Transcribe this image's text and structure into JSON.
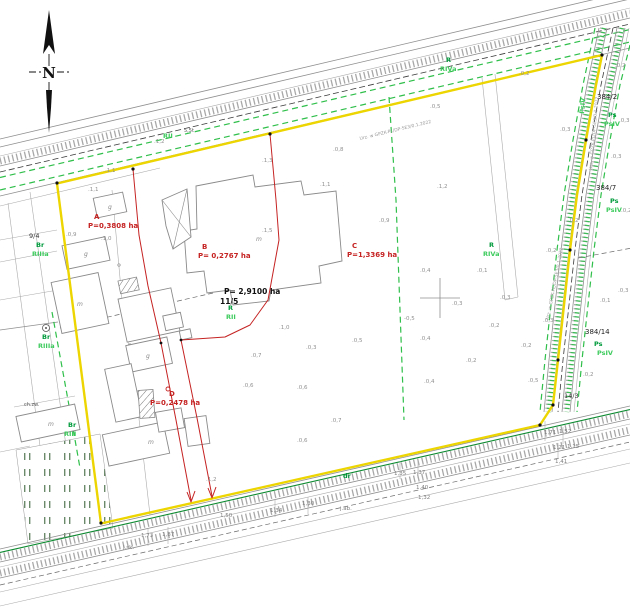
{
  "map_type": "cadastral-survey-map",
  "compass": {
    "north_label": "N"
  },
  "colors": {
    "boundary_yellow": "#ecd500",
    "division_red": "#c52222",
    "vegetation_green": "#2fbf4a",
    "utility_green": "#0c8a30",
    "soil_label_green": "#009a3c",
    "soil_class_green": "#3ecb5e",
    "road_gray": "#8f8f8f"
  },
  "map_labels": [
    {
      "text": "A",
      "x": 94,
      "y": 219,
      "kind": "red",
      "name": "parcel-a-letter"
    },
    {
      "text": "P=0,3808 ha",
      "x": 88,
      "y": 228,
      "kind": "red",
      "name": "parcel-a-area"
    },
    {
      "text": "B",
      "x": 202,
      "y": 249,
      "kind": "red",
      "name": "parcel-b-letter"
    },
    {
      "text": "P= 0,2767 ha",
      "x": 198,
      "y": 258,
      "kind": "red",
      "name": "parcel-b-area"
    },
    {
      "text": "C",
      "x": 352,
      "y": 248,
      "kind": "red",
      "name": "parcel-c-letter"
    },
    {
      "text": "P=1,3369 ha",
      "x": 347,
      "y": 257,
      "kind": "red",
      "name": "parcel-c-area"
    },
    {
      "text": "D",
      "x": 169,
      "y": 396,
      "kind": "red",
      "name": "parcel-d-letter"
    },
    {
      "text": "P=0,2478 ha",
      "x": 150,
      "y": 405,
      "kind": "red",
      "name": "parcel-d-area"
    },
    {
      "text": "P= 2,9100 ha",
      "x": 224,
      "y": 294,
      "kind": "blackb",
      "name": "parcel-115-area"
    },
    {
      "text": "11/5",
      "x": 220,
      "y": 304,
      "kind": "blackb",
      "name": "parcel-115-number"
    },
    {
      "text": "384/2",
      "x": 597,
      "y": 99,
      "kind": "blk",
      "name": "parcel-384-2"
    },
    {
      "text": "384/7",
      "x": 596,
      "y": 190,
      "kind": "blk",
      "name": "parcel-384-7"
    },
    {
      "text": "384/14",
      "x": 585,
      "y": 334,
      "kind": "blk",
      "name": "parcel-384-14"
    },
    {
      "text": "14/3",
      "x": 564,
      "y": 398,
      "kind": "blks",
      "name": "parcel-14-3"
    },
    {
      "text": "9/4",
      "x": 29,
      "y": 238,
      "kind": "blks",
      "name": "parcel-9-4"
    },
    {
      "text": "R",
      "x": 446,
      "y": 62,
      "kind": "grn",
      "name": "soil-label"
    },
    {
      "text": "RIVa",
      "x": 440,
      "y": 71,
      "kind": "grnl",
      "name": "soil-class"
    },
    {
      "text": "R",
      "x": 489,
      "y": 247,
      "kind": "grn",
      "name": "soil-label"
    },
    {
      "text": "RIVa",
      "x": 483,
      "y": 256,
      "kind": "grnl",
      "name": "soil-class"
    },
    {
      "text": "RII",
      "x": 163,
      "y": 138,
      "kind": "grnl",
      "name": "soil-class"
    },
    {
      "text": "R",
      "x": 228,
      "y": 310,
      "kind": "grn",
      "name": "soil-label"
    },
    {
      "text": "RII",
      "x": 226,
      "y": 319,
      "kind": "grnl",
      "name": "soil-class"
    },
    {
      "text": "Br",
      "x": 36,
      "y": 247,
      "kind": "grn",
      "name": "soil-label"
    },
    {
      "text": "RIIIa",
      "x": 32,
      "y": 256,
      "kind": "grnl",
      "name": "soil-class"
    },
    {
      "text": "Br",
      "x": 42,
      "y": 339,
      "kind": "grn",
      "name": "soil-label"
    },
    {
      "text": "RIIIa",
      "x": 38,
      "y": 348,
      "kind": "grnl",
      "name": "soil-class"
    },
    {
      "text": "Br",
      "x": 68,
      "y": 427,
      "kind": "grn",
      "name": "soil-label"
    },
    {
      "text": "RIII",
      "x": 64,
      "y": 436,
      "kind": "grnl",
      "name": "soil-class"
    },
    {
      "text": "Ps",
      "x": 608,
      "y": 117,
      "kind": "grn",
      "name": "soil-label"
    },
    {
      "text": "PsIV",
      "x": 604,
      "y": 126,
      "kind": "grnl",
      "name": "soil-class"
    },
    {
      "text": "Ps",
      "x": 610,
      "y": 203,
      "kind": "grn",
      "name": "soil-label"
    },
    {
      "text": "PsIV",
      "x": 606,
      "y": 212,
      "kind": "grnl",
      "name": "soil-class"
    },
    {
      "text": "Ps",
      "x": 594,
      "y": 346,
      "kind": "grn",
      "name": "soil-label"
    },
    {
      "text": "PsIV",
      "x": 597,
      "y": 355,
      "kind": "grnl",
      "name": "soil-class"
    },
    {
      "text": "dr",
      "x": 343,
      "y": 478,
      "kind": "grn",
      "name": "road-use-label"
    },
    {
      "text": "PsIV",
      "x": 584,
      "y": 114,
      "kind": "grnl",
      "rot": -85,
      "name": "soil-class-rotated"
    },
    {
      "text": "Urz. w GPZK-PL/DP-5E3/0.1.2022",
      "x": 360,
      "y": 140,
      "kind": "util",
      "rot": -13.5,
      "name": "utility-inscription"
    },
    {
      "text": "Urz. w GPZK-PL/DP-5E3/0.1.2022",
      "x": 592,
      "y": 170,
      "kind": "util",
      "rot": -85,
      "name": "utility-inscription"
    },
    {
      "text": "Urz. w GPZK-PL/DP-5E3/0.1.2022",
      "x": 549,
      "y": 320,
      "kind": "util",
      "rot": -79,
      "name": "utility-inscription"
    },
    {
      "text": "5,5t",
      "x": 184,
      "y": 132,
      "kind": "tiny",
      "name": "road-sign-label"
    },
    {
      "text": "ch.zw.",
      "x": 24,
      "y": 406,
      "kind": "tiny",
      "name": "surface-label"
    },
    {
      "text": "m",
      "x": 256,
      "y": 241,
      "kind": "bld",
      "name": "building-use-label"
    },
    {
      "text": "m",
      "x": 77,
      "y": 306,
      "kind": "bld",
      "name": "building-use-label"
    },
    {
      "text": "m",
      "x": 148,
      "y": 444,
      "kind": "bld",
      "name": "building-use-label"
    },
    {
      "text": "m",
      "x": 48,
      "y": 426,
      "kind": "bld",
      "name": "building-use-label"
    },
    {
      "text": "g",
      "x": 108,
      "y": 209,
      "kind": "bld",
      "name": "building-use-label"
    },
    {
      "text": "g",
      "x": 84,
      "y": 256,
      "kind": "bld",
      "name": "building-use-label"
    },
    {
      "text": "g",
      "x": 146,
      "y": 358,
      "kind": "bld",
      "name": "building-use-label"
    },
    {
      "text": ".1,2",
      "x": 154,
      "y": 143,
      "kind": "spot",
      "name": "spot-height"
    },
    {
      "text": ".1,3",
      "x": 262,
      "y": 162,
      "kind": "spot",
      "name": "spot-height"
    },
    {
      "text": ".0,8",
      "x": 333,
      "y": 151,
      "kind": "spot",
      "name": "spot-height"
    },
    {
      "text": ".0,5",
      "x": 430,
      "y": 108,
      "kind": "spot",
      "name": "spot-height"
    },
    {
      "text": ".0,2",
      "x": 519,
      "y": 75,
      "kind": "spot",
      "name": "spot-height"
    },
    {
      "text": ".0,3",
      "x": 560,
      "y": 131,
      "kind": "spot",
      "name": "spot-height"
    },
    {
      "text": ".0,2",
      "x": 615,
      "y": 67,
      "kind": "spot",
      "name": "spot-height"
    },
    {
      "text": ".0,3",
      "x": 619,
      "y": 122,
      "kind": "spot",
      "name": "spot-height"
    },
    {
      "text": ".0,3",
      "x": 611,
      "y": 158,
      "kind": "spot",
      "name": "spot-height"
    },
    {
      "text": ".0,2",
      "x": 568,
      "y": 222,
      "kind": "spot",
      "name": "spot-height"
    },
    {
      "text": ".0,2",
      "x": 621,
      "y": 212,
      "kind": "spot",
      "name": "spot-height"
    },
    {
      "text": ".0,3",
      "x": 618,
      "y": 292,
      "kind": "spot",
      "name": "spot-height"
    },
    {
      "text": ".0,1",
      "x": 600,
      "y": 302,
      "kind": "spot",
      "name": "spot-height"
    },
    {
      "text": ".0,2",
      "x": 546,
      "y": 252,
      "kind": "spot",
      "name": "spot-height"
    },
    {
      "text": ".1,1",
      "x": 105,
      "y": 172,
      "kind": "spot",
      "name": "spot-height"
    },
    {
      "text": ".1,0",
      "x": 101,
      "y": 240,
      "kind": "spot",
      "name": "spot-height"
    },
    {
      "text": ".1,5",
      "x": 262,
      "y": 232,
      "kind": "spot",
      "name": "spot-height"
    },
    {
      "text": ".1,1",
      "x": 320,
      "y": 186,
      "kind": "spot",
      "name": "spot-height"
    },
    {
      "text": ".0,9",
      "x": 379,
      "y": 222,
      "kind": "spot",
      "name": "spot-height"
    },
    {
      "text": ".0,4",
      "x": 420,
      "y": 272,
      "kind": "spot",
      "name": "spot-height"
    },
    {
      "text": ".0,1",
      "x": 477,
      "y": 272,
      "kind": "spot",
      "name": "spot-height"
    },
    {
      "text": ".0,3",
      "x": 452,
      "y": 305,
      "kind": "spot",
      "name": "spot-height"
    },
    {
      "text": "-0,5",
      "x": 404,
      "y": 320,
      "kind": "spot",
      "name": "spot-height"
    },
    {
      "text": ".0,3",
      "x": 500,
      "y": 299,
      "kind": "spot",
      "name": "spot-height"
    },
    {
      "text": ".0,2",
      "x": 489,
      "y": 327,
      "kind": "spot",
      "name": "spot-height"
    },
    {
      "text": ".0,4",
      "x": 420,
      "y": 340,
      "kind": "spot",
      "name": "spot-height"
    },
    {
      "text": ".1,0",
      "x": 279,
      "y": 329,
      "kind": "spot",
      "name": "spot-height"
    },
    {
      "text": ".0,7",
      "x": 251,
      "y": 357,
      "kind": "spot",
      "name": "spot-height"
    },
    {
      "text": ".0,3",
      "x": 306,
      "y": 349,
      "kind": "spot",
      "name": "spot-height"
    },
    {
      "text": ".0,5",
      "x": 352,
      "y": 342,
      "kind": "spot",
      "name": "spot-height"
    },
    {
      "text": ".0,6",
      "x": 297,
      "y": 389,
      "kind": "spot",
      "name": "spot-height"
    },
    {
      "text": ".0,6",
      "x": 243,
      "y": 387,
      "kind": "spot",
      "name": "spot-height"
    },
    {
      "text": ".0,7",
      "x": 331,
      "y": 422,
      "kind": "spot",
      "name": "spot-height"
    },
    {
      "text": ".0,6",
      "x": 297,
      "y": 442,
      "kind": "spot",
      "name": "spot-height"
    },
    {
      "text": ".0,4",
      "x": 424,
      "y": 383,
      "kind": "spot",
      "name": "spot-height"
    },
    {
      "text": ".0,2",
      "x": 466,
      "y": 362,
      "kind": "spot",
      "name": "spot-height"
    },
    {
      "text": ".0,2",
      "x": 521,
      "y": 347,
      "kind": "spot",
      "name": "spot-height"
    },
    {
      "text": ".0,3",
      "x": 543,
      "y": 322,
      "kind": "spot",
      "name": "spot-height"
    },
    {
      "text": ".1,2",
      "x": 437,
      "y": 188,
      "kind": "spot",
      "name": "spot-height"
    },
    {
      "text": ".1,1",
      "x": 88,
      "y": 191,
      "kind": "spot",
      "name": "spot-height"
    },
    {
      "text": ".0,9",
      "x": 66,
      "y": 236,
      "kind": "spot",
      "name": "spot-height"
    },
    {
      "text": ".0,2",
      "x": 583,
      "y": 376,
      "kind": "spot",
      "name": "spot-height"
    },
    {
      "text": ".0,5",
      "x": 528,
      "y": 382,
      "kind": "spot",
      "name": "spot-height"
    },
    {
      "text": ".1,2",
      "x": 206,
      "y": 481,
      "kind": "spot",
      "name": "spot-height"
    },
    {
      "text": "1,73",
      "x": 141,
      "y": 537,
      "kind": "dim",
      "name": "dimension-label"
    },
    {
      "text": "1,87",
      "x": 162,
      "y": 536,
      "kind": "dim",
      "name": "dimension-label"
    },
    {
      "text": "j.sk.",
      "x": 123,
      "y": 549,
      "kind": "dim",
      "name": "dimension-label"
    },
    {
      "text": "1,50",
      "x": 220,
      "y": 517,
      "kind": "dim",
      "name": "dimension-label"
    },
    {
      "text": "1,34",
      "x": 270,
      "y": 512,
      "kind": "dim",
      "name": "dimension-label"
    },
    {
      "text": "1,30",
      "x": 302,
      "y": 505,
      "kind": "dim",
      "name": "dimension-label"
    },
    {
      "text": "j.ab.",
      "x": 340,
      "y": 510,
      "kind": "dim",
      "name": "dimension-label"
    },
    {
      "text": "1,35",
      "x": 394,
      "y": 475,
      "kind": "dim",
      "name": "dimension-label"
    },
    {
      "text": "1,37",
      "x": 413,
      "y": 474,
      "kind": "dim",
      "name": "dimension-label"
    },
    {
      "text": "1,40",
      "x": 416,
      "y": 489,
      "kind": "dim",
      "name": "dimension-label"
    },
    {
      "text": "1,32",
      "x": 418,
      "y": 499,
      "kind": "dim",
      "name": "dimension-label"
    },
    {
      "text": "1,71",
      "x": 544,
      "y": 434,
      "kind": "dim",
      "name": "dimension-label"
    },
    {
      "text": "1,52",
      "x": 559,
      "y": 433,
      "kind": "dim",
      "name": "dimension-label"
    },
    {
      "text": "1,21",
      "x": 553,
      "y": 449,
      "kind": "dim",
      "name": "dimension-label"
    },
    {
      "text": "1,15",
      "x": 567,
      "y": 448,
      "kind": "dim",
      "name": "dimension-label"
    },
    {
      "text": "1,41",
      "x": 555,
      "y": 463,
      "kind": "dim",
      "name": "dimension-label"
    }
  ]
}
